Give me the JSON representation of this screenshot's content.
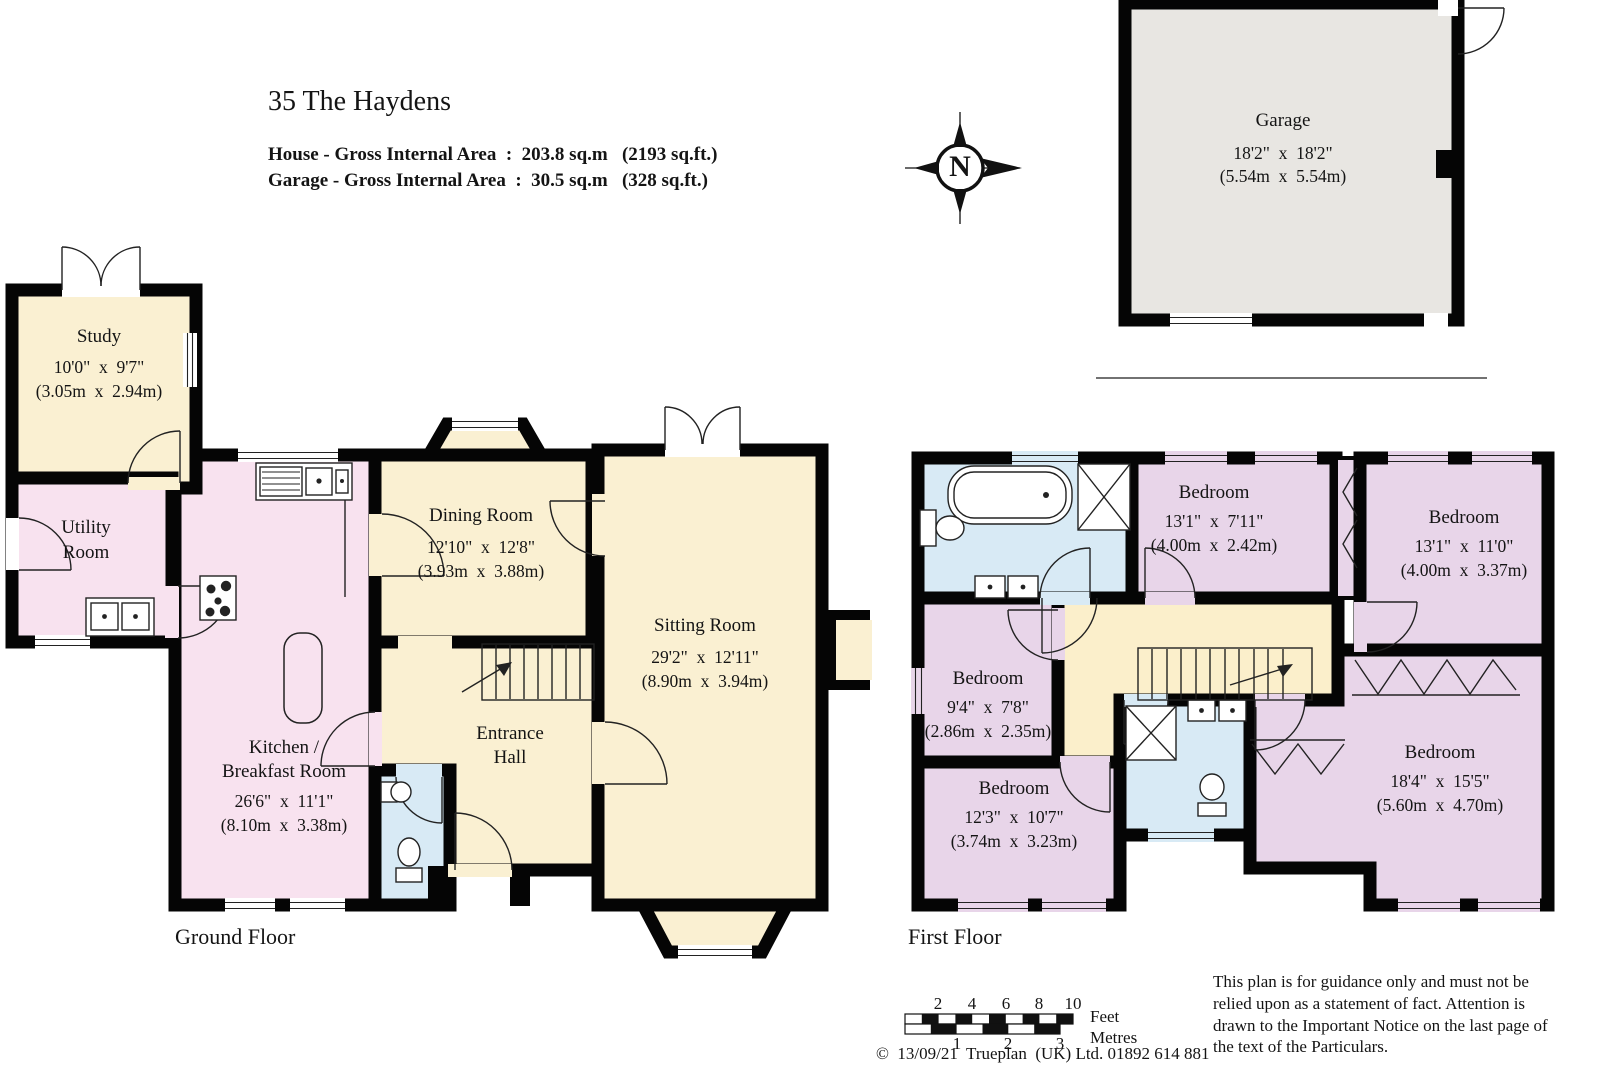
{
  "header": {
    "title": "35 The Haydens",
    "house_area_line": "House - Gross Internal Area  :  203.8 sq.m   (2193 sq.ft.)",
    "garage_area_line": "Garage - Gross Internal Area  :  30.5 sq.m   (328 sq.ft.)"
  },
  "compass": {
    "north_letter": "N"
  },
  "garage": {
    "name": "Garage",
    "imperial": "18'2\"  x  18'2\"",
    "metric": "(5.54m  x  5.54m)"
  },
  "ground_floor": {
    "label": "Ground Floor",
    "rooms": {
      "study": {
        "name": "Study",
        "imperial": "10'0\"  x  9'7\"",
        "metric": "(3.05m  x  2.94m)"
      },
      "utility": {
        "name_line1": "Utility",
        "name_line2": "Room"
      },
      "kitchen": {
        "name_line1": "Kitchen /",
        "name_line2": "Breakfast Room",
        "imperial": "26'6\"  x  11'1\"",
        "metric": "(8.10m  x  3.38m)"
      },
      "dining": {
        "name": "Dining Room",
        "imperial": "12'10\"  x  12'8\"",
        "metric": "(3.93m  x  3.88m)"
      },
      "sitting": {
        "name": "Sitting Room",
        "imperial": "29'2\"  x  12'11\"",
        "metric": "(8.90m  x  3.94m)"
      },
      "entrance": {
        "name_line1": "Entrance",
        "name_line2": "Hall"
      }
    }
  },
  "first_floor": {
    "label": "First Floor",
    "rooms": {
      "bedroom_top_mid": {
        "name": "Bedroom",
        "imperial": "13'1\"  x  7'11\"",
        "metric": "(4.00m  x  2.42m)"
      },
      "bedroom_top_right": {
        "name": "Bedroom",
        "imperial": "13'1\"  x  11'0\"",
        "metric": "(4.00m  x  3.37m)"
      },
      "bedroom_mid_left": {
        "name": "Bedroom",
        "imperial": "9'4\"  x  7'8\"",
        "metric": "(2.86m  x  2.35m)"
      },
      "bedroom_bottom_left": {
        "name": "Bedroom",
        "imperial": "12'3\"  x  10'7\"",
        "metric": "(3.74m  x  3.23m)"
      },
      "bedroom_bottom_right": {
        "name": "Bedroom",
        "imperial": "18'4\"  x  15'5\"",
        "metric": "(5.60m  x  4.70m)"
      }
    }
  },
  "scale_bar": {
    "feet_ticks": [
      "2",
      "4",
      "6",
      "8",
      "10"
    ],
    "metres_ticks": [
      "1",
      "2",
      "3"
    ],
    "feet_label": "Feet",
    "metres_label": "Metres"
  },
  "footer": {
    "copyright": "©  13/09/21  Trueplan  (UK) Ltd. 01892 614 881",
    "disclaimer": "This plan is for guidance only and must not be relied upon as a statement of fact. Attention is drawn to the Important Notice on the last page of the text of the Particulars."
  },
  "colors": {
    "cream": "#FAF0D2",
    "pink": "#F8E2EF",
    "lilac": "#E8D5E9",
    "blue": "#D8EAF5",
    "landing": "#FBEFCB",
    "garage_grey": "#E8E6E2",
    "wall": "#050505"
  }
}
